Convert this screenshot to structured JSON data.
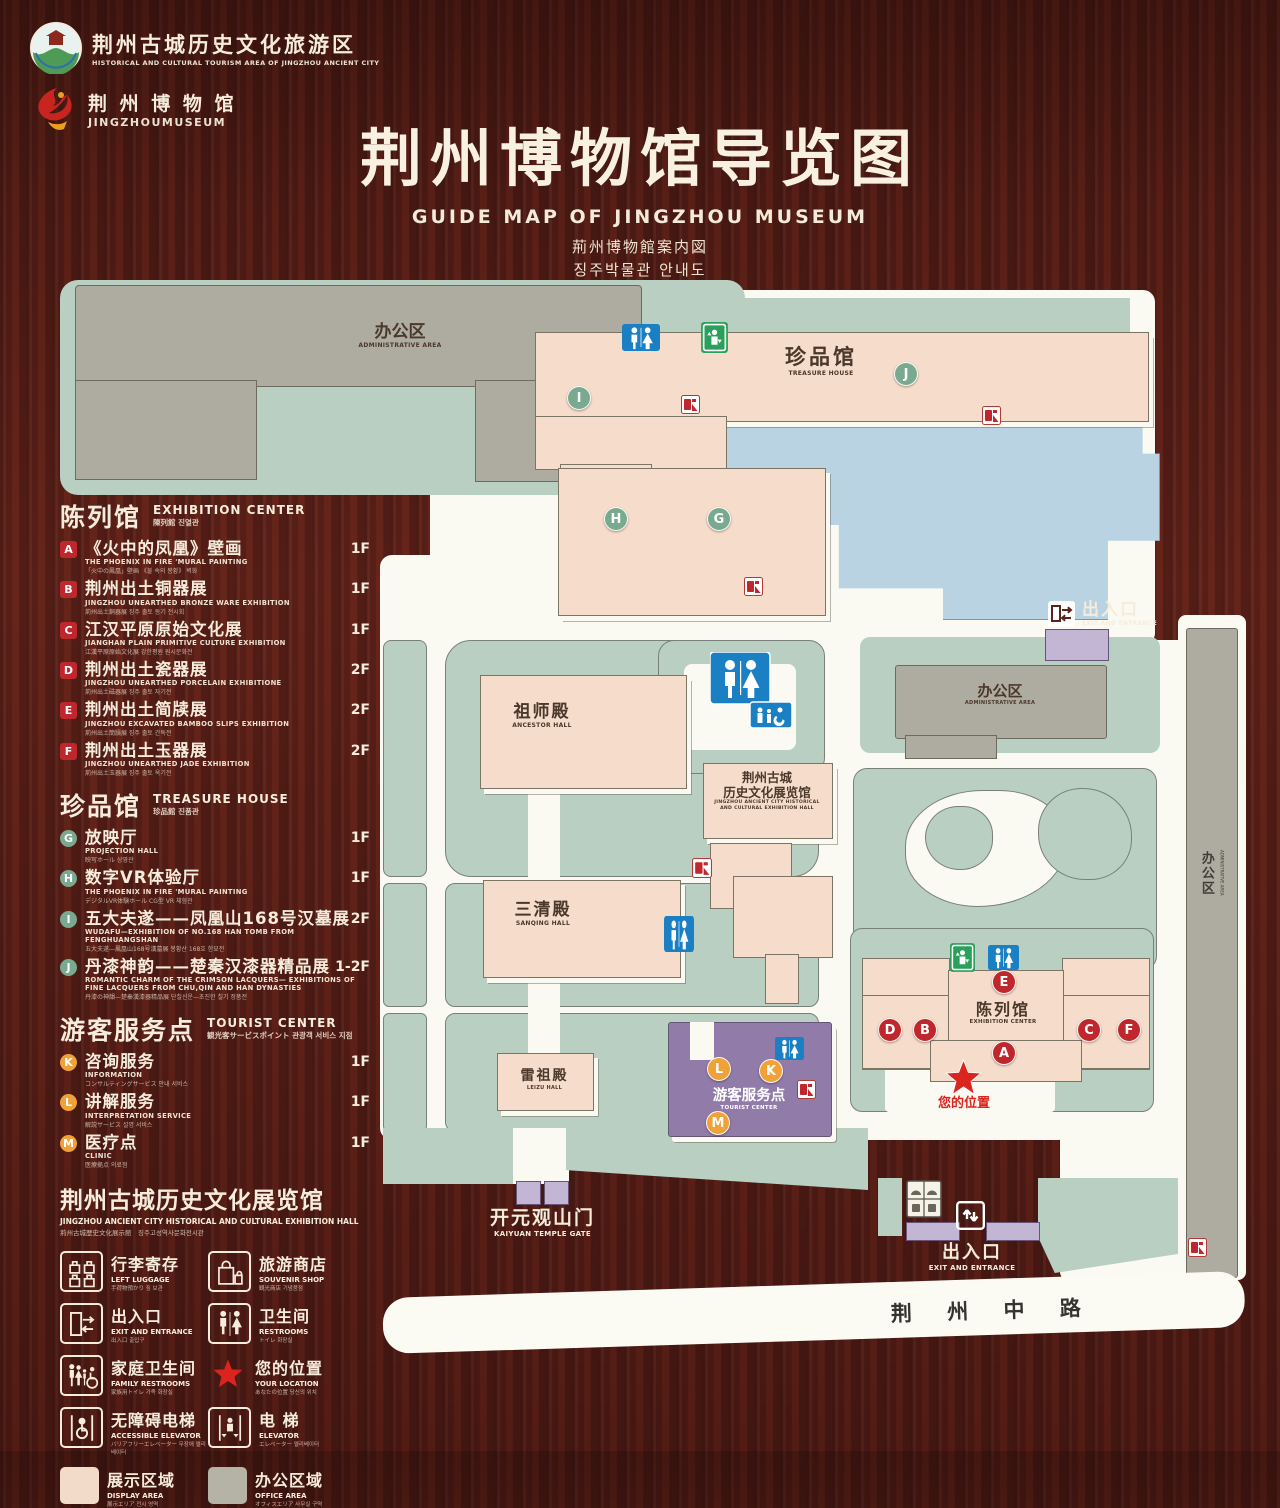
{
  "header": {
    "org1": {
      "zh": "荆州古城历史文化旅游区",
      "en": "HISTORICAL AND CULTURAL TOURISM AREA OF JINGZHOU ANCIENT CITY"
    },
    "org2": {
      "zh": "荆 州 博 物 馆",
      "en": "JINGZHOUMUSEUM"
    },
    "title": "荆州博物馆导览图",
    "subtitle_en": "GUIDE MAP OF JINGZHOU MUSEUM",
    "subtitle_ja": "荊州博物館案内図",
    "subtitle_ko": "징주박물관 안내도"
  },
  "colors": {
    "marker_red": "#c0272d",
    "marker_green": "#79a98e",
    "marker_orange": "#f0a137",
    "display_area": "#f2dbc9",
    "office_area": "#b5b2a6",
    "restroom_blue": "#1b7fc4",
    "elevator_green": "#2aa05a",
    "location_red": "#d9251d"
  },
  "legend": {
    "sections": [
      {
        "id": "exhibition-center",
        "title_zh": "陈列馆",
        "title_en": "EXHIBITION CENTER",
        "title_sub": "陳列館  진열관",
        "marker": "red",
        "shape": "sq",
        "items": [
          {
            "letter": "A",
            "zh": "《火中的凤凰》壁画",
            "en": "THE PHOENIX IN FIRE 'MURAL PAINTING",
            "sub": "「火中の鳳凰」壁画 《불 속의 봉황》 벽화",
            "floor": "1F"
          },
          {
            "letter": "B",
            "zh": "荆州出土铜器展",
            "en": "JINGZHOU UNEARTHED BRONZE WARE EXHIBITION",
            "sub": "荊州出土銅器展  징주 출토 동기 전시회",
            "floor": "1F"
          },
          {
            "letter": "C",
            "zh": "江汉平原原始文化展",
            "en": "JIANGHAN PLAIN PRIMITIVE CULTURE EXHIBITION",
            "sub": "江漢平原原始文化展  강한평원 원시문화전",
            "floor": "1F"
          },
          {
            "letter": "D",
            "zh": "荆州出土瓷器展",
            "en": "JINGZHOU UNEARTHED PORCELAIN EXHIBITIONE",
            "sub": "荊州出土磁器展  징주 출토 자기전",
            "floor": "2F"
          },
          {
            "letter": "E",
            "zh": "荆州出土简牍展",
            "en": "JINGZHOU EXCAVATED BAMBOO SLIPS EXHIBITION",
            "sub": "荊州出土簡牘展  징주 출토 간독전",
            "floor": "2F"
          },
          {
            "letter": "F",
            "zh": "荆州出土玉器展",
            "en": "JINGZHOU UNEARTHED JADE EXHIBITION",
            "sub": "荊州出土玉器展  징주 출토 옥기전",
            "floor": "2F"
          }
        ]
      },
      {
        "id": "treasure-house",
        "title_zh": "珍品馆",
        "title_en": "TREASURE HOUSE",
        "title_sub": "珍品館  진품관",
        "marker": "green",
        "shape": "",
        "items": [
          {
            "letter": "G",
            "zh": "放映厅",
            "en": "PROJECTION HALL",
            "sub": "映写ホール  상영관",
            "floor": "1F"
          },
          {
            "letter": "H",
            "zh": "数字VR体验厅",
            "en": "THE PHOENIX IN FIRE 'MURAL PAINTING",
            "sub": "デジタルVR体験ホール  CG型 VR 체험관",
            "floor": "1F"
          },
          {
            "letter": "I",
            "zh": "五大夫遂——凤凰山168号汉墓展",
            "en": "WUDAFU—EXHIBITION OF NO.168 HAN TOMB FROM FENGHUANGSHAN",
            "sub": "五大夫遂—鳳凰山168号漢墓展  봉황산 168호 한묘전",
            "floor": "2F"
          },
          {
            "letter": "J",
            "zh": "丹漆神韵——楚秦汉漆器精品展",
            "en": "ROMANTIC CHARM OF THE CRIMSON LACQUERS— EXHIBITIONS OF FINE LACQUERS FROM CHU,QIN AND HAN DYNASTIES",
            "sub": "丹漆の神韻—楚秦漢漆器精品展  단칠신운—초진한 칠기 정품전",
            "floor": "1-2F"
          }
        ]
      },
      {
        "id": "tourist-center",
        "title_zh": "游客服务点",
        "title_en": "TOURIST CENTER",
        "title_sub": "観光客サービスポイント  관광객 서비스 지점",
        "marker": "orange",
        "shape": "",
        "items": [
          {
            "letter": "K",
            "zh": "咨询服务",
            "en": "INFORMATION",
            "sub": "コンサルティングサービス  안내 서비스",
            "floor": "1F"
          },
          {
            "letter": "L",
            "zh": "讲解服务",
            "en": "INTERPRETATION SERVICE",
            "sub": "解説サービス  설명 서비스",
            "floor": "1F"
          },
          {
            "letter": "M",
            "zh": "医疗点",
            "en": "CLINIC",
            "sub": "医療拠点  의료점",
            "floor": "1F"
          }
        ]
      }
    ],
    "hall_note": {
      "zh": "荆州古城历史文化展览馆",
      "en": "JINGZHOU ANCIENT CITY HISTORICAL AND CULTURAL EXHIBITION HALL",
      "sub": "荊州古城歴史文化展示館　징주고성역사문화전시관"
    },
    "facilities": [
      {
        "id": "left-luggage",
        "zh": "行李寄存",
        "en": "LEFT LUGGAGE",
        "sub": "手荷物預かり  짐 보관"
      },
      {
        "id": "souvenir-shop",
        "zh": "旅游商店",
        "en": "SOUVENIR SHOP",
        "sub": "観光商店  기념품점"
      },
      {
        "id": "exit-entrance",
        "zh": "出入口",
        "en": "EXIT AND ENTRANCE",
        "sub": "出入口  출입구"
      },
      {
        "id": "restrooms",
        "zh": "卫生间",
        "en": "RESTROOMS",
        "sub": "トイレ  화장실"
      },
      {
        "id": "family-restrooms",
        "zh": "家庭卫生间",
        "en": "FAMILY RESTROOMS",
        "sub": "家族用トイレ  가족 화장실"
      },
      {
        "id": "your-location",
        "zh": "您的位置",
        "en": "YOUR LOCATION",
        "sub": "あなたの位置  당신의 위치"
      },
      {
        "id": "accessible-elevator",
        "zh": "无障碍电梯",
        "en": "ACCESSIBLE ELEVATOR",
        "sub": "バリアフリーエレベーター  무장애 엘리베이터"
      },
      {
        "id": "elevator",
        "zh": "电  梯",
        "en": "ELEVATOR",
        "sub": "エレベーター  엘리베이터"
      },
      {
        "id": "display-area",
        "zh": "展示区域",
        "en": "DISPLAY AREA",
        "sub": "展示エリア  전시 영역"
      },
      {
        "id": "office-area",
        "zh": "办公区域",
        "en": "OFFICE AREA",
        "sub": "オフィスエリア  사무실 구역"
      }
    ]
  },
  "map": {
    "labels": {
      "admin_tl": {
        "zh": "办公区",
        "en": "ADMINISTRATIVE AREA"
      },
      "treasure": {
        "zh": "珍品馆",
        "en": "TREASURE HOUSE"
      },
      "ancestor": {
        "zh": "祖师殿",
        "en": "ANCESTOR HALL"
      },
      "sanqing": {
        "zh": "三清殿",
        "en": "SANQING HALL"
      },
      "leizu": {
        "zh": "雷祖殿",
        "en": "LEIZU HALL"
      },
      "exhall_zh1": "荆州古城",
      "exhall_zh2": "历史文化展览馆",
      "exhall_en1": "JINGZHOU ANCIENT CITY HISTORICAL",
      "exhall_en2": "AND CULTURAL EXHIBITION HALL",
      "admin_r": {
        "zh": "办公区",
        "en": "ADMINISTRATIVE AREA"
      },
      "admin_strip": {
        "zh": "办公区",
        "en": "ADMINISTRATIVE AREA"
      },
      "tourist": {
        "zh": "游客服务点",
        "en": "TOURIST CENTER"
      },
      "excenter": {
        "zh": "陈列馆",
        "en": "EXHIBITION CENTER"
      },
      "gate": {
        "zh": "开元观山门",
        "en": "KAIYUAN TEMPLE GATE"
      },
      "exit_top": {
        "zh": "出入口",
        "en": "EXIT AND ENTRANCE"
      },
      "exit_bottom": {
        "zh": "出入口",
        "en": "EXIT AND ENTRANCE"
      },
      "your_location": "您的位置",
      "road": "荆  州  中  路"
    },
    "markers": [
      {
        "letter": "I",
        "color": "green",
        "x": 578,
        "y": 397
      },
      {
        "letter": "J",
        "color": "green",
        "x": 905,
        "y": 373
      },
      {
        "letter": "H",
        "color": "green",
        "x": 615,
        "y": 518
      },
      {
        "letter": "G",
        "color": "green",
        "x": 718,
        "y": 518
      },
      {
        "letter": "E",
        "color": "red",
        "x": 1003,
        "y": 981
      },
      {
        "letter": "D",
        "color": "red",
        "x": 889,
        "y": 1029
      },
      {
        "letter": "B",
        "color": "red",
        "x": 924,
        "y": 1029
      },
      {
        "letter": "C",
        "color": "red",
        "x": 1088,
        "y": 1029
      },
      {
        "letter": "F",
        "color": "red",
        "x": 1128,
        "y": 1029
      },
      {
        "letter": "A",
        "color": "red",
        "x": 1003,
        "y": 1052
      },
      {
        "letter": "L",
        "color": "orange",
        "x": 718,
        "y": 1068
      },
      {
        "letter": "K",
        "color": "orange",
        "x": 770,
        "y": 1070
      },
      {
        "letter": "M",
        "color": "orange",
        "x": 717,
        "y": 1122
      }
    ],
    "icons": [
      {
        "type": "restroom",
        "x": 622,
        "y": 324,
        "w": 38,
        "h": 27
      },
      {
        "type": "elevator",
        "x": 701,
        "y": 322,
        "w": 27,
        "h": 31
      },
      {
        "type": "restroom-family",
        "x": 710,
        "y": 652,
        "w": 82,
        "h": 76
      },
      {
        "type": "restroom",
        "x": 664,
        "y": 916,
        "w": 30,
        "h": 36
      },
      {
        "type": "restroom",
        "x": 775,
        "y": 1037,
        "w": 29,
        "h": 23
      },
      {
        "type": "restroom",
        "x": 988,
        "y": 945,
        "w": 31,
        "h": 25
      },
      {
        "type": "elevator",
        "x": 950,
        "y": 943,
        "w": 25,
        "h": 29
      },
      {
        "type": "fire",
        "x": 681,
        "y": 395,
        "w": 19,
        "h": 19
      },
      {
        "type": "fire",
        "x": 982,
        "y": 406,
        "w": 19,
        "h": 19
      },
      {
        "type": "fire",
        "x": 744,
        "y": 577,
        "w": 19,
        "h": 19
      },
      {
        "type": "fire",
        "x": 692,
        "y": 858,
        "w": 20,
        "h": 20
      },
      {
        "type": "fire",
        "x": 797,
        "y": 1080,
        "w": 19,
        "h": 19
      },
      {
        "type": "fire",
        "x": 1188,
        "y": 1238,
        "w": 19,
        "h": 19
      },
      {
        "type": "exit-lr",
        "x": 1048,
        "y": 601,
        "w": 27,
        "h": 25
      },
      {
        "type": "exit-ud",
        "x": 956,
        "y": 1201,
        "w": 29,
        "h": 29
      },
      {
        "type": "ticket",
        "x": 906,
        "y": 1180,
        "w": 36,
        "h": 38
      },
      {
        "type": "star",
        "x": 943,
        "y": 1058,
        "w": 41,
        "h": 41
      }
    ]
  }
}
